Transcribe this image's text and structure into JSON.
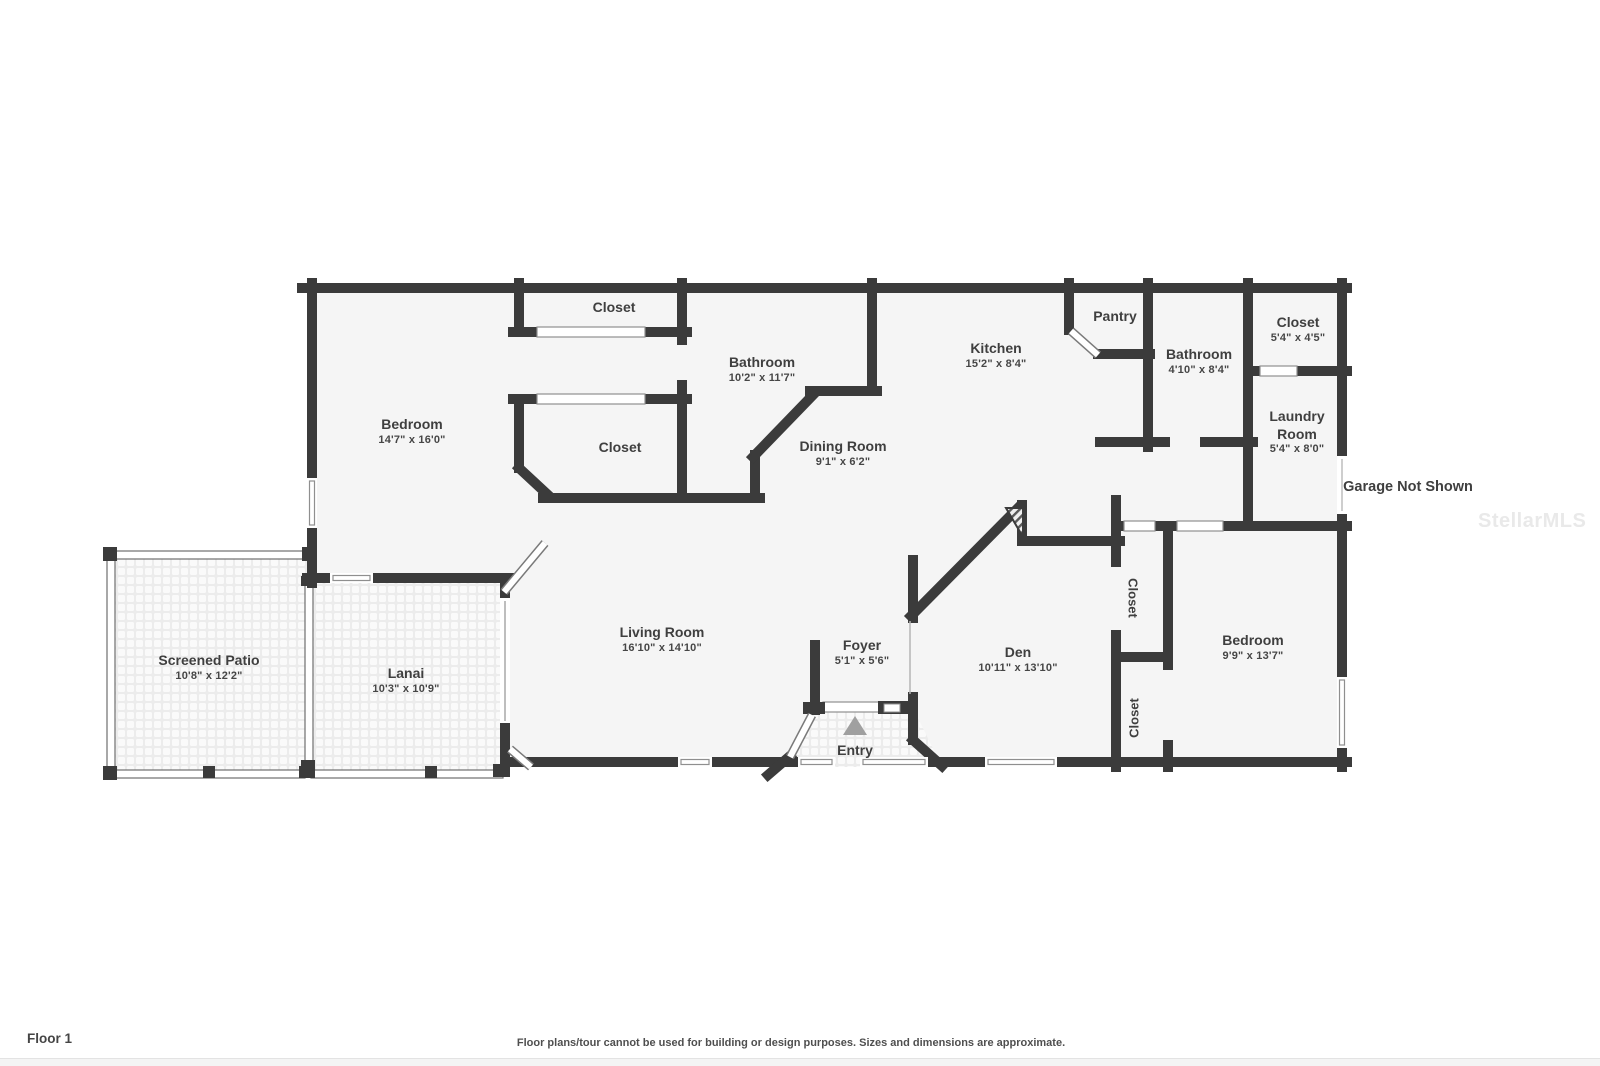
{
  "footer": {
    "floor_label": "Floor 1",
    "disclaimer": "Floor plans/tour cannot be used for building or design purposes. Sizes and dimensions are approximate."
  },
  "watermark": "StellarMLS",
  "annotations": {
    "garage_note": "Garage Not Shown"
  },
  "colors": {
    "wall": "#3b3b3b",
    "room_fill": "#f5f5f5",
    "label_text": "#3f3f3f",
    "entry_arrow": "#a0a0a0",
    "watermark_text": "#e9e9e9"
  },
  "rooms": {
    "bedroom_main": {
      "name": "Bedroom",
      "dims": "14'7\" x 16'0\""
    },
    "closet_top": {
      "name": "Closet"
    },
    "bathroom_main": {
      "name": "Bathroom",
      "dims": "10'2\" x 11'7\""
    },
    "closet_mid": {
      "name": "Closet"
    },
    "dining": {
      "name": "Dining Room",
      "dims": "9'1\" x 6'2\""
    },
    "kitchen": {
      "name": "Kitchen",
      "dims": "15'2\" x 8'4\""
    },
    "pantry": {
      "name": "Pantry"
    },
    "bathroom2": {
      "name": "Bathroom",
      "dims": "4'10\" x 8'4\""
    },
    "closet_right": {
      "name": "Closet",
      "dims": "5'4\" x 4'5\""
    },
    "laundry": {
      "name": "Laundry Room",
      "dims": "5'4\" x 8'0\""
    },
    "living": {
      "name": "Living Room",
      "dims": "16'10\" x 14'10\""
    },
    "foyer": {
      "name": "Foyer",
      "dims": "5'1\" x 5'6\""
    },
    "den": {
      "name": "Den",
      "dims": "10'11\" x 13'10\""
    },
    "closet_den": {
      "name": "Closet"
    },
    "closet_bed2": {
      "name": "Closet"
    },
    "bedroom2": {
      "name": "Bedroom",
      "dims": "9'9\" x 13'7\""
    },
    "patio": {
      "name": "Screened Patio",
      "dims": "10'8\" x 12'2\""
    },
    "lanai": {
      "name": "Lanai",
      "dims": "10'3\" x 10'9\""
    },
    "entry": {
      "name": "Entry"
    }
  }
}
